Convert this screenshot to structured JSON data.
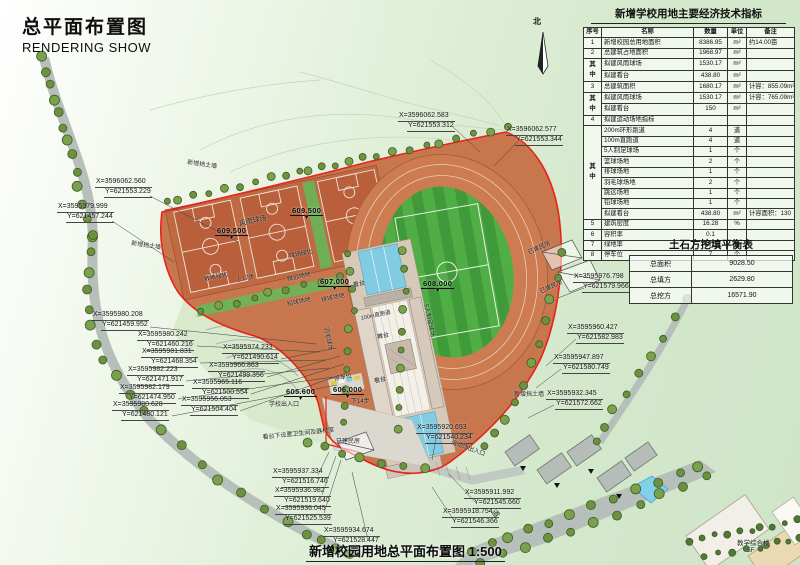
{
  "title": {
    "cn": "总平面布置图",
    "en": "RENDERING SHOW"
  },
  "bottom_title": "新增校园用地总平面布置图 1:500",
  "compass": {
    "label": "北"
  },
  "indicator_table": {
    "title": "新增学校用地主要经济技术指标",
    "headers": [
      "序号",
      "名称",
      "数量",
      "单位",
      "备注"
    ],
    "merge_top": "其",
    "merge_bottom": "中",
    "rows": [
      {
        "no": "1",
        "name": "新增校园总用地面积",
        "qty": "8386.95",
        "unit": "m²",
        "note": "约14.00亩"
      },
      {
        "no": "2",
        "name": "总建筑占地面积",
        "qty": "1968.97",
        "unit": "m²",
        "note": ""
      },
      {
        "no": "",
        "name": "拟建风雨球场",
        "qty": "1530.17",
        "unit": "m²",
        "note": ""
      },
      {
        "no": "",
        "name": "拟建看台",
        "qty": "438.80",
        "unit": "m²",
        "note": ""
      },
      {
        "no": "3",
        "name": "总建筑面积",
        "qty": "1680.17",
        "unit": "m²",
        "note": "计容：855.09m²"
      },
      {
        "no": "",
        "name": "拟建风雨球场",
        "qty": "1530.17",
        "unit": "m²",
        "note": "计容：765.09m²"
      },
      {
        "no": "",
        "name": "拟建看台",
        "qty": "150",
        "unit": "m²",
        "note": ""
      },
      {
        "no": "4",
        "name": "拟建运动场地指标",
        "qty": "",
        "unit": "",
        "note": ""
      },
      {
        "no": "",
        "name": "200m环形跑道",
        "qty": "4",
        "unit": "道",
        "note": ""
      },
      {
        "no": "",
        "name": "100m直跑道",
        "qty": "4",
        "unit": "道",
        "note": ""
      },
      {
        "no": "",
        "name": "5人制足球场",
        "qty": "1",
        "unit": "个",
        "note": ""
      },
      {
        "no": "",
        "name": "篮球场地",
        "qty": "2",
        "unit": "个",
        "note": ""
      },
      {
        "no": "",
        "name": "排球场地",
        "qty": "1",
        "unit": "个",
        "note": ""
      },
      {
        "no": "",
        "name": "羽毛球场地",
        "qty": "2",
        "unit": "个",
        "note": ""
      },
      {
        "no": "",
        "name": "跳远场地",
        "qty": "1",
        "unit": "个",
        "note": ""
      },
      {
        "no": "",
        "name": "铅球场地",
        "qty": "1",
        "unit": "个",
        "note": ""
      },
      {
        "no": "",
        "name": "拟建看台",
        "qty": "438.80",
        "unit": "m²",
        "note": "计容面积：130"
      },
      {
        "no": "5",
        "name": "建筑密度",
        "qty": "16.28",
        "unit": "%",
        "note": ""
      },
      {
        "no": "6",
        "name": "容积率",
        "qty": "0.1",
        "unit": "",
        "note": ""
      },
      {
        "no": "7",
        "name": "绿地率",
        "qty": "30.5",
        "unit": "%",
        "note": ""
      },
      {
        "no": "8",
        "name": "停车位",
        "qty": "7",
        "unit": "个",
        "note": ""
      }
    ]
  },
  "earthwork_table": {
    "title": "土石方挖填平衡表",
    "rows": [
      {
        "k": "总面积",
        "v": "9028.50"
      },
      {
        "k": "总填方",
        "v": "2629.80"
      },
      {
        "k": "总挖方",
        "v": "16571.90"
      }
    ]
  },
  "coordinates": [
    {
      "x": "X=3596062.583",
      "y": "Y=621553.312"
    },
    {
      "x": "X=3596062.577",
      "y": "Y=621553.344"
    },
    {
      "x": "X=3596062.560",
      "y": "Y=621553.229"
    },
    {
      "x": "X=3595979.999",
      "y": "Y=621457.244"
    },
    {
      "x": "X=3595980.208",
      "y": "Y=621459.952"
    },
    {
      "x": "X=3595980.242",
      "y": "Y=621460.216"
    },
    {
      "x": "X=3595981.831",
      "y": "Y=621468.354"
    },
    {
      "x": "X=3595982.223",
      "y": "Y=621471.917"
    },
    {
      "x": "X=3595982.179",
      "y": "Y=621474.950"
    },
    {
      "x": "X=3595980.628",
      "y": "Y=621480.121"
    },
    {
      "x": "X=3595974.233",
      "y": "Y=621490.614"
    },
    {
      "x": "X=3595966.863",
      "y": "Y=621499.356"
    },
    {
      "x": "X=3595965.116",
      "y": "Y=621500.554"
    },
    {
      "x": "X=3595956.053",
      "y": "Y=621504.404"
    },
    {
      "x": "X=3595976.798",
      "y": "Y=621579.966"
    },
    {
      "x": "X=3595960.427",
      "y": "Y=621582.983"
    },
    {
      "x": "X=3595947.897",
      "y": "Y=621580.749"
    },
    {
      "x": "X=3595932.345",
      "y": "Y=621572.662"
    },
    {
      "x": "X=3595920.693",
      "y": "Y=621540.234"
    },
    {
      "x": "X=3595911.992",
      "y": "Y=621545.660"
    },
    {
      "x": "X=3595918.754",
      "y": "Y=621546.366"
    },
    {
      "x": "X=3595937.334",
      "y": "Y=621516.746"
    },
    {
      "x": "X=3595936.982",
      "y": "Y=621519.640"
    },
    {
      "x": "X=3595936.045",
      "y": "Y=621525.539"
    },
    {
      "x": "X=3595934.674",
      "y": "Y=621528.447"
    }
  ],
  "levels": [
    {
      "value": "609.500"
    },
    {
      "value": "609.500"
    },
    {
      "value": "607.000"
    },
    {
      "value": "608.000"
    },
    {
      "value": "606.000"
    },
    {
      "value": "605.600"
    }
  ],
  "site_labels": [
    {
      "text": "风雨球场"
    },
    {
      "text": "球场绿化"
    },
    {
      "text": "坡地绿化"
    },
    {
      "text": "上17步"
    },
    {
      "text": "跳远场地"
    },
    {
      "text": "排球场地"
    },
    {
      "text": "铅球场地"
    },
    {
      "text": "羽毛球场"
    },
    {
      "text": "看台"
    },
    {
      "text": "舞台"
    },
    {
      "text": "看台"
    },
    {
      "text": "100m直跑道"
    },
    {
      "text": "停车位"
    },
    {
      "text": "5人制足球场"
    },
    {
      "text": "下14步"
    },
    {
      "text": "已建民房"
    },
    {
      "text": "已建民房"
    },
    {
      "text": "已建民房"
    },
    {
      "text": "新增挡土墙"
    },
    {
      "text": "新增挡土墙"
    },
    {
      "text": "新增挡土墙"
    },
    {
      "text": "看台下设置卫生间及器材室"
    },
    {
      "text": "学校出入口"
    },
    {
      "text": "运动场出入口"
    },
    {
      "text": "道"
    },
    {
      "text": "教学综合楼"
    },
    {
      "text": "5F"
    }
  ],
  "colors": {
    "site_orange": "#c8764e",
    "court_orange": "#bf6a43",
    "field_green": "#3f9b3a",
    "boundary_red": "#e8231a",
    "tree_green": "#6c9240",
    "water_cyan": "#7fd0e8"
  }
}
